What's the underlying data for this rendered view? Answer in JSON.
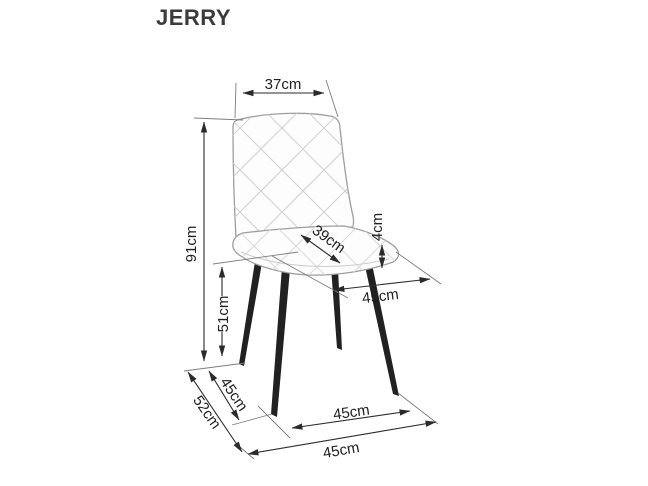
{
  "title": "JERRY",
  "product_type": "chair dimension diagram",
  "colors": {
    "background": "#ffffff",
    "dimension_lines": "#2b2b2b",
    "chair_outline": "#9e9e9e",
    "quilt_pattern": "#d0d0d0",
    "legs": "#212121",
    "text": "#1f1f1f"
  },
  "dimensions": {
    "backrest_width": {
      "label": "37cm"
    },
    "total_height": {
      "label": "91cm"
    },
    "seat_height": {
      "label": "51cm"
    },
    "seat_depth": {
      "label": "39cm"
    },
    "cushion_thickness": {
      "label": "4cm"
    },
    "seat_width": {
      "label": "45cm"
    },
    "leg_span_depth": {
      "label": "45cm"
    },
    "total_depth": {
      "label": "52cm"
    },
    "front_leg_span": {
      "label": "45cm"
    },
    "total_width": {
      "label": "45cm"
    }
  }
}
